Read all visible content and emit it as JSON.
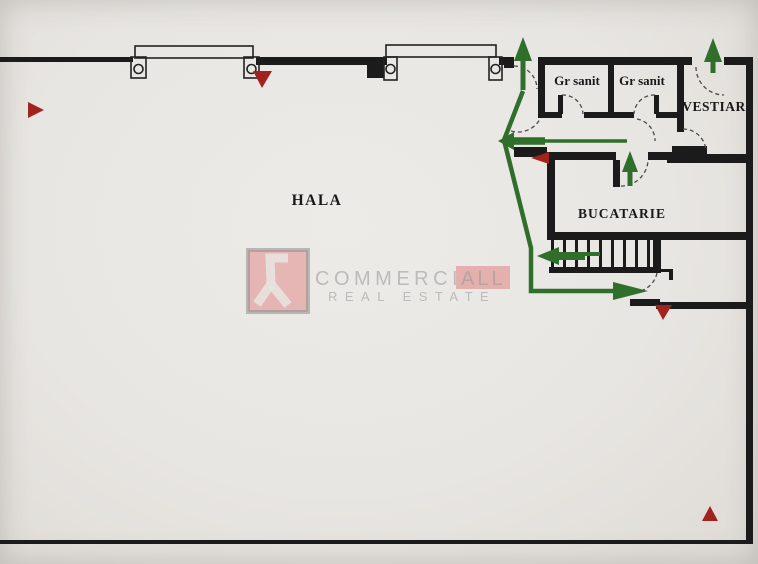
{
  "labels": {
    "hala": "HALA",
    "gr_sanit_1": "Gr sanit",
    "gr_sanit_2": "Gr sanit",
    "vestiar": "VESTIAR",
    "bucatarie": "BUCATARIE"
  },
  "watermark": {
    "brand_part1": "COMMERCI",
    "brand_part2": "ALL",
    "tagline": "REAL ESTATE",
    "logo_icon": "commerciall-logo"
  },
  "route_arrows": [
    {
      "name": "exit-arrow-top-left",
      "direction": "up",
      "color": "#2f6e2b"
    },
    {
      "name": "exit-arrow-top-right",
      "direction": "up",
      "color": "#2f6e2b"
    },
    {
      "name": "bucatarie-exit-arrow",
      "direction": "up",
      "color": "#2f6e2b"
    },
    {
      "name": "corridor-arrow",
      "direction": "left",
      "color": "#2f6e2b"
    },
    {
      "name": "stairs-arrow",
      "direction": "left",
      "color": "#2f6e2b"
    },
    {
      "name": "lower-exit-arrow",
      "direction": "right",
      "color": "#2f6e2b"
    }
  ],
  "markers": [
    {
      "name": "red-triangle-marker-left-wall",
      "direction": "right",
      "color": "#a2231e"
    },
    {
      "name": "red-triangle-marker-top-wall",
      "direction": "down",
      "color": "#a2231e"
    },
    {
      "name": "red-triangle-marker-corridor",
      "direction": "left",
      "color": "#a2231e"
    },
    {
      "name": "red-triangle-marker-lower-exit",
      "direction": "down",
      "color": "#a2231e"
    },
    {
      "name": "red-triangle-marker-bottom-right",
      "direction": "up",
      "color": "#a2231e"
    }
  ],
  "colors": {
    "paper": "#e8e6e2",
    "wall": "#1b1b1b",
    "route_green": "#2f6e2b",
    "marker_red": "#a2231e",
    "watermark_pink": "#dd8181",
    "watermark_gray": "#9a9a9a"
  }
}
